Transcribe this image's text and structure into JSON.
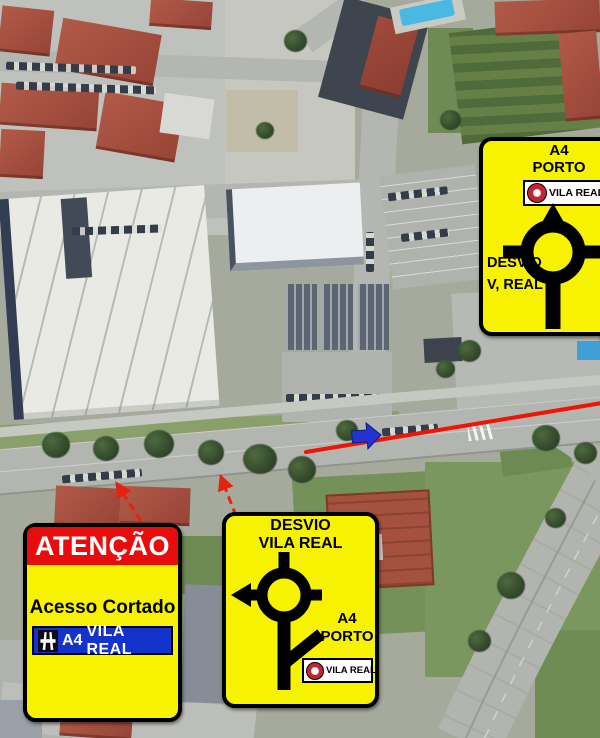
{
  "signs": {
    "top_detour": {
      "route": "A4",
      "destination": "PORTO",
      "no_entry": "VILA REAL",
      "note_line1": "DESVIO",
      "note_line2": "V, REAL"
    },
    "bottom_detour": {
      "title_line1": "DESVIO",
      "title_line2": "VILA REAL",
      "route": "A4",
      "destination": "PORTO",
      "no_entry": "VILA REAL"
    },
    "attention": {
      "header": "ATENÇÃO",
      "message": "Acesso Cortado",
      "badge_route": "A4",
      "badge_destination": "VILA REAL"
    }
  },
  "colors": {
    "sign_yellow": "#f7f300",
    "alert_red": "#e90c0c",
    "badge_blue": "#1433cc",
    "no_entry_red": "#c32430",
    "route_line_red": "#ee1506",
    "direction_arrow_blue": "#2433cf"
  }
}
